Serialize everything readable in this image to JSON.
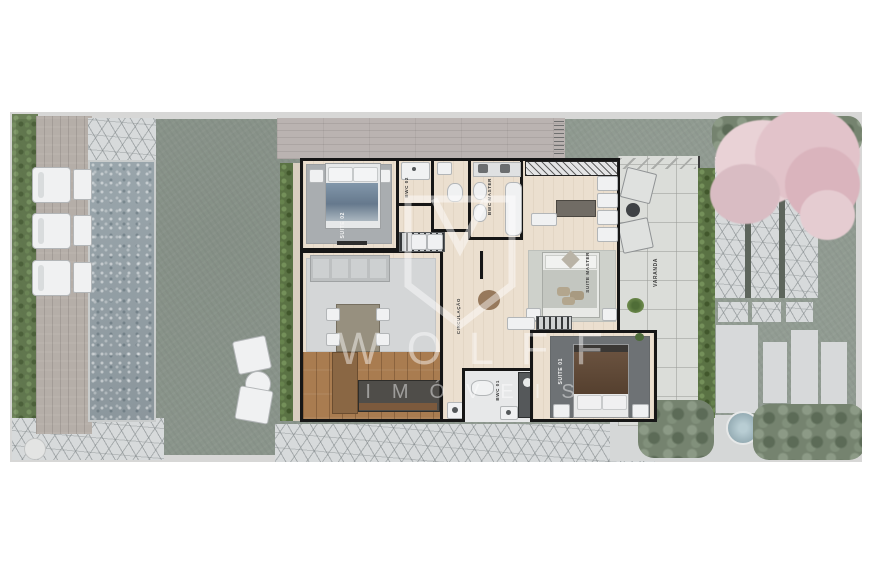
{
  "rooms": {
    "suite02": {
      "label": "SUITE 02"
    },
    "bwc02": {
      "label": "BWC 02"
    },
    "bwc_master": {
      "label": "BWC MASTER"
    },
    "suite_master": {
      "label": "SUITE MASTER"
    },
    "varanda": {
      "label": "VARANDA"
    },
    "circulacao": {
      "label": "CIRCULAÇÃO"
    },
    "bwc01": {
      "label": "BWC 01"
    },
    "suite01": {
      "label": "SUITE 01"
    }
  },
  "watermark": {
    "brand": "WOLFF",
    "tagline": "IMÓVEIS"
  },
  "colors": {
    "lawn": "#8E998F",
    "pool": "#96A1A7",
    "house_floor": "#EBDFCF",
    "walls": "#161616",
    "hedge": "#5A7244",
    "blossom_tree": "#E2C3CA",
    "deck_wood": "#B5AEA8",
    "kitchen_wood": "#A97C50",
    "watermark": "#FFFFFF"
  }
}
